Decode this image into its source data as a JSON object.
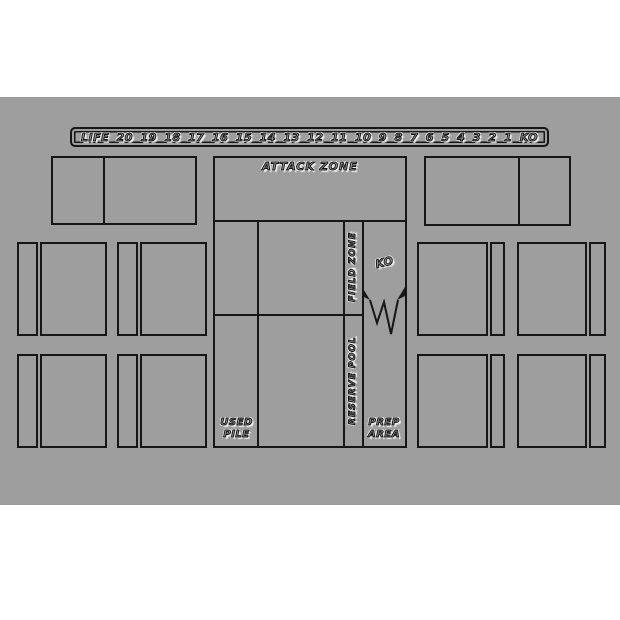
{
  "playmat": {
    "colors": {
      "mat": "#9e9e9e",
      "line": "#161616",
      "page": "#ffffff"
    },
    "life_track": {
      "label": "LIFE",
      "values": [
        "20",
        "19",
        "18",
        "17",
        "16",
        "15",
        "14",
        "13",
        "12",
        "11",
        "10",
        "9",
        "8",
        "7",
        "6",
        "5",
        "4",
        "3",
        "2",
        "1"
      ],
      "ko_label": "KO"
    },
    "zones": {
      "attack_zone": "ATTACK ZONE",
      "field_zone": "FIELD ZONE",
      "reserve_pool": "RESERVE POOL",
      "ko": "KO",
      "used_pile": "USED PILE",
      "prep_area": "PREP AREA"
    }
  }
}
